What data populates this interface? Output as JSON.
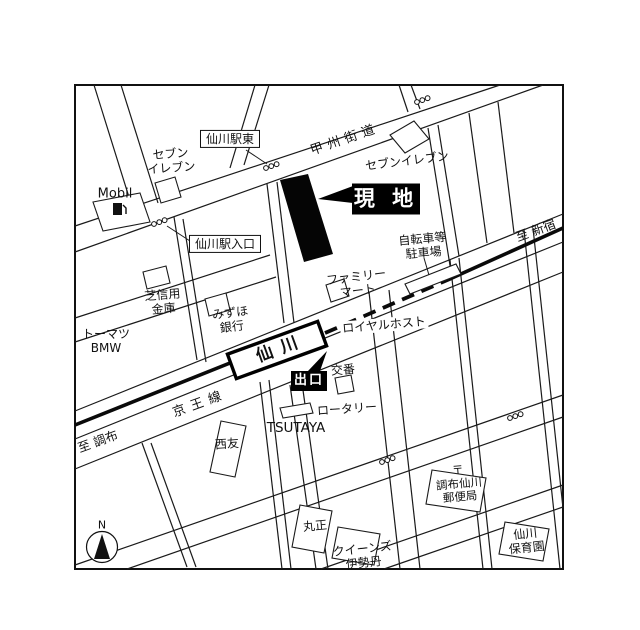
{
  "map": {
    "title_note": "仙川駅周辺案内図",
    "labels": {
      "station_east": "仙川駅東",
      "seven_eleven_west": "セブン\nイレブン",
      "mobil": "Mobil",
      "koshu_kaido": "甲州街道",
      "seven_eleven_east": "セブンイレブン",
      "site": "現 地",
      "bicycle_parking": "自転車等\n駐車場",
      "to_shinjuku": "至 新宿",
      "station_entrance": "仙川駅入口",
      "family_mart": "ファミリー\nマート",
      "shiba_shinkin": "芝信用\n金庫",
      "mizuho_bank": "みずほ\n銀行",
      "royal_host": "ロイヤルホスト",
      "tomatsu_bmw": "トーマツ\nBMW",
      "station_name": "仙川",
      "exit": "出口",
      "koban": "交番",
      "rotary": "ロータリー",
      "tsutaya": "TSUTAYA",
      "seiyu": "西友",
      "keio_line": "京王線",
      "to_chofu": "至 調布",
      "post_office": "〒\n調布仙川\n郵便局",
      "marusho": "丸正",
      "queens_isetan": "クイーンズ\n伊勢丹",
      "nursery": "仙川\n保育園",
      "compass_north": "N"
    },
    "colors": {
      "line": "#1a1a1a",
      "background": "#ffffff",
      "site_fill": "#000000",
      "callout_bg": "#000000",
      "callout_text": "#ffffff"
    }
  }
}
